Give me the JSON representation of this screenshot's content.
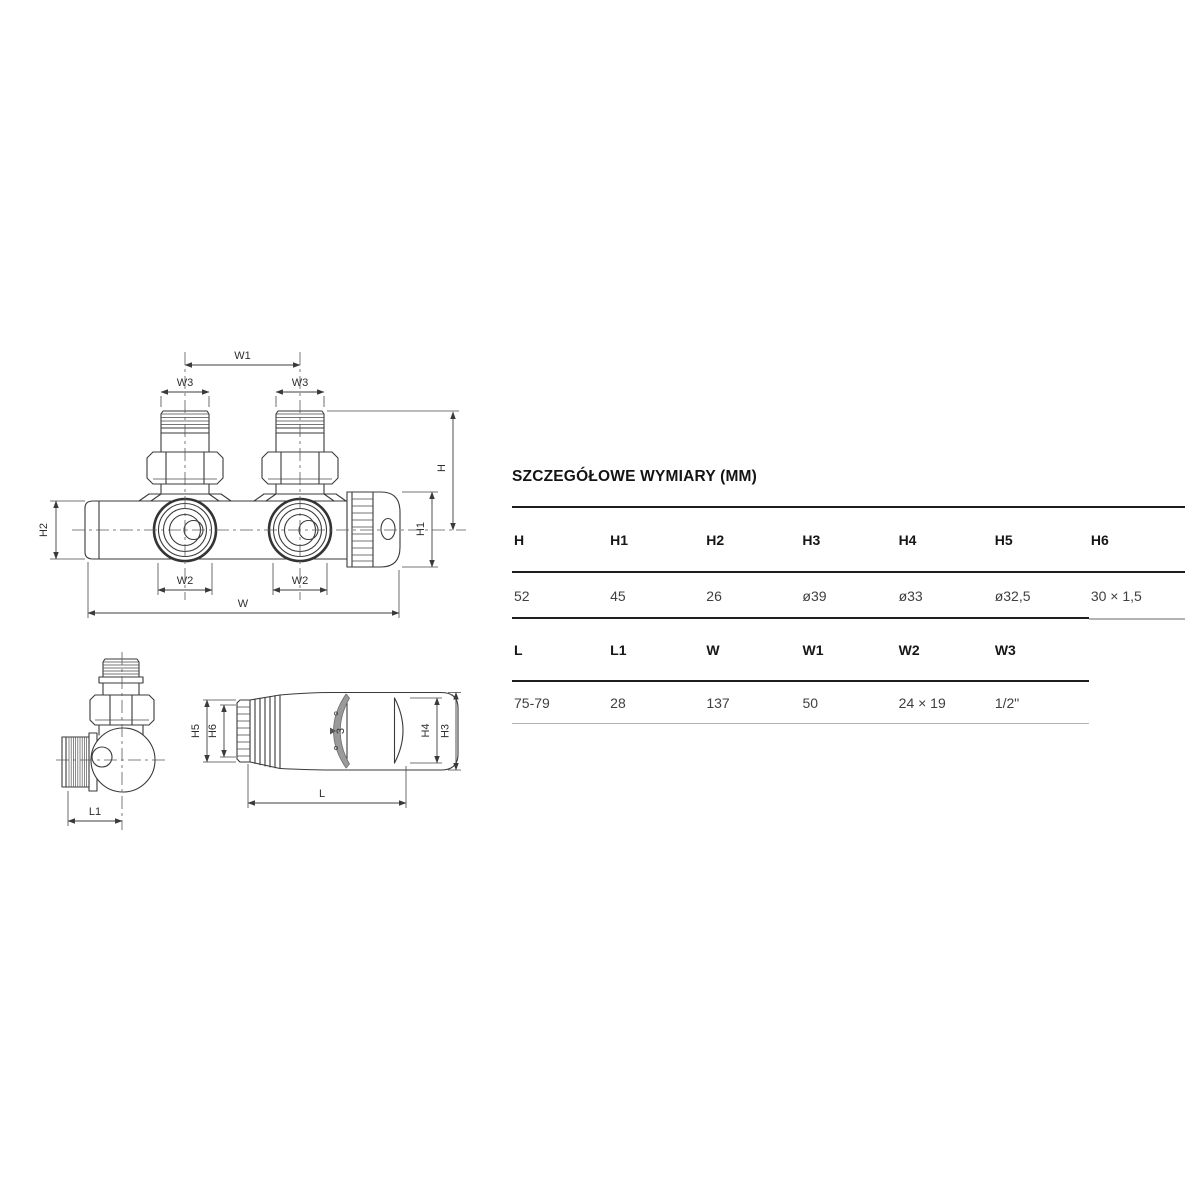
{
  "title": "SZCZEGÓŁOWE WYMIARY (MM)",
  "tables": [
    {
      "headers": [
        "H",
        "H1",
        "H2",
        "H3",
        "H4",
        "H5",
        "H6"
      ],
      "values": [
        "52",
        "45",
        "26",
        "ø39",
        "ø33",
        "ø32,5",
        "30 × 1,5"
      ]
    },
    {
      "headers": [
        "L",
        "L1",
        "W",
        "W1",
        "W2",
        "W3"
      ],
      "values": [
        "75-79",
        "28",
        "137",
        "50",
        "24 × 19",
        "1/2\""
      ]
    }
  ],
  "drawing": {
    "front_view": {
      "w1": "W1",
      "w3_left": "W3",
      "w3_right": "W3",
      "h": "H",
      "h1": "H1",
      "h2": "H2",
      "w2_left": "W2",
      "w2_right": "W2",
      "w": "W"
    },
    "corner_view": {
      "l1": "L1"
    },
    "head_view": {
      "h5": "H5",
      "h6": "H6",
      "h4": "H4",
      "h3": "H3",
      "l": "L",
      "setting_number": "3"
    }
  },
  "colors": {
    "background": "#ffffff",
    "drawing_line": "#3a3a3a",
    "centerline": "#5a5a5a",
    "table_dark_border": "#1e1e1e",
    "table_light_border": "#b3b3b3",
    "header_text": "#161616",
    "value_text": "#3f3f3f"
  }
}
